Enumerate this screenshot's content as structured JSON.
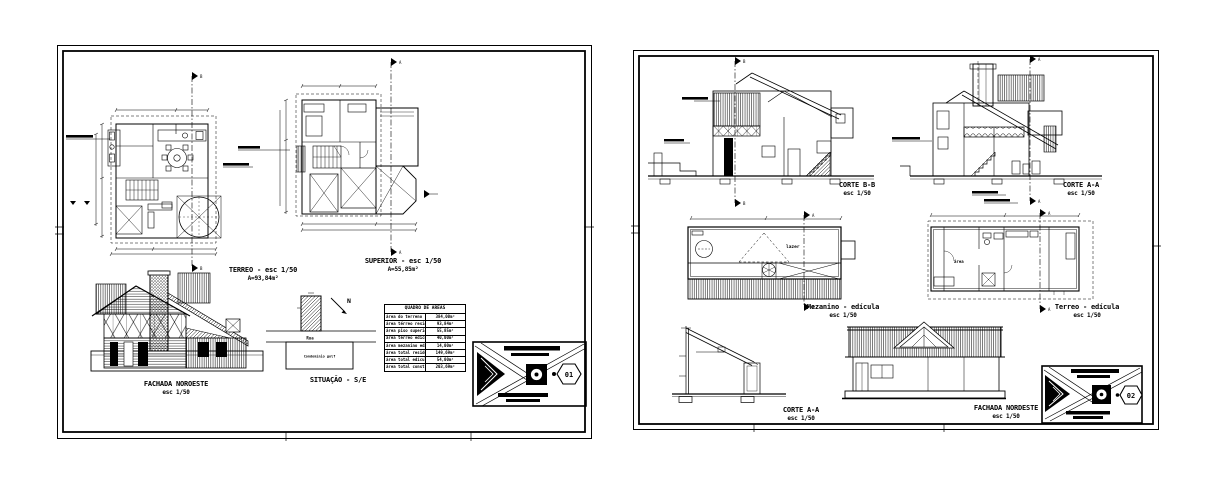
{
  "app": {
    "background": "#ffffff",
    "ink": "#000000"
  },
  "letters": {
    "a": "A",
    "b": "B"
  },
  "sheet1": {
    "number": "01",
    "terreo": {
      "title": "TERREO - esc 1/50",
      "area": "A=93,84m²"
    },
    "superior": {
      "title": "SUPERIOR - esc 1/50",
      "area": "A=55,85m²"
    },
    "fachada": {
      "title": "FACHADA NOROESTE",
      "scale": "esc 1/50"
    },
    "situacao": {
      "title": "SITUAÇÃO - S/E",
      "street": "Rua",
      "condo": "Condomínio golf",
      "north": "N"
    },
    "quadro": {
      "title": "QUADRO DE AREAS",
      "rows": [
        {
          "label": "área do terreno",
          "value": "384,00m²"
        },
        {
          "label": "área térreo residência",
          "value": "93,84m²"
        },
        {
          "label": "área piso superior",
          "value": "55,85m²"
        },
        {
          "label": "área térreo edícula",
          "value": "40,00m²"
        },
        {
          "label": "área mezanino edícula",
          "value": "14,00m²"
        },
        {
          "label": "área total residência",
          "value": "149,69m²"
        },
        {
          "label": "área total edícula",
          "value": "54,00m²"
        },
        {
          "label": "área total construída",
          "value": "203,69m²"
        }
      ]
    }
  },
  "sheet2": {
    "number": "02",
    "corte_bb": {
      "title": "CORTE B-B",
      "scale": "esc 1/50"
    },
    "corte_aa": {
      "title": "CORTE A-A",
      "scale": "esc 1/50"
    },
    "mezanino": {
      "title": "Mezanino - edícula",
      "scale": "esc 1/50",
      "room": "lazer"
    },
    "terreo_edicula": {
      "title": "Terreo - edícula",
      "scale": "esc 1/50",
      "room": "área"
    },
    "corte_aa2": {
      "title": "CORTE A-A",
      "scale": "esc 1/50"
    },
    "fachada": {
      "title": "FACHADA NORDESTE",
      "scale": "esc 1/50"
    }
  }
}
